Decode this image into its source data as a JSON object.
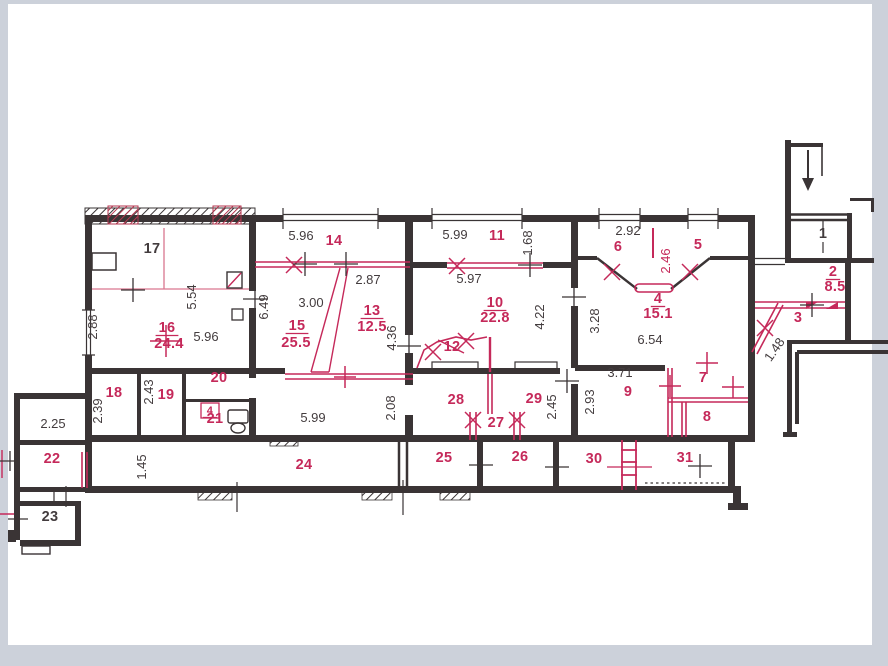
{
  "meta": {
    "type": "apartment-floor-plan",
    "style": "scanned technical drawing (BTI plan) with black walls and red re-planning annotations"
  },
  "colors": {
    "wall": "#3a3435",
    "ink": "#433c3e",
    "red": "#c5295a",
    "redl": "#d9768f",
    "paper": "#ffffff",
    "frame": "#ccd1da"
  },
  "icons": {
    "stairs": "down-arrow",
    "wc": "toilet",
    "shaft": "vent-box-with-red-cross",
    "doors": "red-x-swing-marks",
    "new_openings": "plus-tick-marks"
  },
  "labels": [
    {
      "t": "17",
      "x": 152,
      "y": 253,
      "c": "k",
      "k": "room"
    },
    {
      "t": "16",
      "x": 167,
      "y": 332,
      "c": "r",
      "k": "room",
      "u": 1
    },
    {
      "t": "24.4",
      "x": 169,
      "y": 348,
      "c": "r",
      "k": "room"
    },
    {
      "t": "14",
      "x": 334,
      "y": 245,
      "c": "r",
      "k": "room"
    },
    {
      "t": "15",
      "x": 297,
      "y": 330,
      "c": "r",
      "k": "room",
      "u": 1
    },
    {
      "t": "25.5",
      "x": 296,
      "y": 347,
      "c": "r",
      "k": "room"
    },
    {
      "t": "13",
      "x": 372,
      "y": 315,
      "c": "r",
      "k": "room",
      "u": 1
    },
    {
      "t": "12.5",
      "x": 372,
      "y": 331,
      "c": "r",
      "k": "room"
    },
    {
      "t": "12",
      "x": 452,
      "y": 351,
      "c": "r",
      "k": "room",
      "strike": 1
    },
    {
      "t": "11",
      "x": 497,
      "y": 240,
      "c": "r",
      "k": "room"
    },
    {
      "t": "10",
      "x": 495,
      "y": 307,
      "c": "r",
      "k": "room",
      "u": 1
    },
    {
      "t": "22.8",
      "x": 495,
      "y": 322,
      "c": "r",
      "k": "room"
    },
    {
      "t": "6",
      "x": 618,
      "y": 251,
      "c": "r",
      "k": "room"
    },
    {
      "t": "5",
      "x": 698,
      "y": 249,
      "c": "r",
      "k": "room"
    },
    {
      "t": "4",
      "x": 658,
      "y": 303,
      "c": "r",
      "k": "room",
      "u": 1
    },
    {
      "t": "15.1",
      "x": 658,
      "y": 318,
      "c": "r",
      "k": "room"
    },
    {
      "t": "3",
      "x": 798,
      "y": 322,
      "c": "r",
      "k": "room"
    },
    {
      "t": "2",
      "x": 833,
      "y": 276,
      "c": "r",
      "k": "room",
      "u": 1
    },
    {
      "t": "8.5",
      "x": 835,
      "y": 291,
      "c": "r",
      "k": "room"
    },
    {
      "t": "1",
      "x": 823,
      "y": 238,
      "c": "k",
      "k": "room"
    },
    {
      "t": "9",
      "x": 628,
      "y": 396,
      "c": "r",
      "k": "room"
    },
    {
      "t": "7",
      "x": 703,
      "y": 382,
      "c": "r",
      "k": "room"
    },
    {
      "t": "8",
      "x": 707,
      "y": 421,
      "c": "r",
      "k": "room"
    },
    {
      "t": "18",
      "x": 114,
      "y": 397,
      "c": "r",
      "k": "room"
    },
    {
      "t": "19",
      "x": 166,
      "y": 399,
      "c": "r",
      "k": "room"
    },
    {
      "t": "20",
      "x": 219,
      "y": 382,
      "c": "r",
      "k": "room"
    },
    {
      "t": "21",
      "x": 215,
      "y": 423,
      "c": "r",
      "k": "room"
    },
    {
      "t": "4",
      "x": 210,
      "y": 414,
      "c": "r",
      "k": "room",
      "fs": 11,
      "u": 1,
      "name": "fixture-label"
    },
    {
      "t": "22",
      "x": 52,
      "y": 463,
      "c": "r",
      "k": "room"
    },
    {
      "t": "23",
      "x": 50,
      "y": 521,
      "c": "k",
      "k": "room"
    },
    {
      "t": "24",
      "x": 304,
      "y": 469,
      "c": "r",
      "k": "room"
    },
    {
      "t": "25",
      "x": 444,
      "y": 462,
      "c": "r",
      "k": "room"
    },
    {
      "t": "26",
      "x": 520,
      "y": 461,
      "c": "r",
      "k": "room"
    },
    {
      "t": "27",
      "x": 496,
      "y": 427,
      "c": "r",
      "k": "room"
    },
    {
      "t": "28",
      "x": 456,
      "y": 404,
      "c": "r",
      "k": "room"
    },
    {
      "t": "29",
      "x": 534,
      "y": 403,
      "c": "r",
      "k": "room"
    },
    {
      "t": "30",
      "x": 594,
      "y": 463,
      "c": "r",
      "k": "room"
    },
    {
      "t": "31",
      "x": 685,
      "y": 462,
      "c": "r",
      "k": "room"
    },
    {
      "t": "5.96",
      "x": 301,
      "y": 240,
      "c": "k",
      "k": "dim"
    },
    {
      "t": "5.99",
      "x": 455,
      "y": 239,
      "c": "k",
      "k": "dim"
    },
    {
      "t": "1.68",
      "x": 532,
      "y": 243,
      "c": "k",
      "k": "dim",
      "rot": -90
    },
    {
      "t": "2.92",
      "x": 628,
      "y": 235,
      "c": "k",
      "k": "dim"
    },
    {
      "t": "2.46",
      "x": 670,
      "y": 261,
      "c": "r",
      "k": "dim",
      "rot": -90
    },
    {
      "t": "2.87",
      "x": 368,
      "y": 284,
      "c": "k",
      "k": "dim"
    },
    {
      "t": "5.97",
      "x": 469,
      "y": 283,
      "c": "k",
      "k": "dim"
    },
    {
      "t": "5.54",
      "x": 196,
      "y": 297,
      "c": "k",
      "k": "dim",
      "rot": -90
    },
    {
      "t": "6.49",
      "x": 268,
      "y": 307,
      "c": "k",
      "k": "dim",
      "rot": -90
    },
    {
      "t": "3.00",
      "x": 311,
      "y": 307,
      "c": "k",
      "k": "dim"
    },
    {
      "t": "2.88",
      "x": 97,
      "y": 327,
      "c": "k",
      "k": "dim",
      "rot": -90
    },
    {
      "t": "5.96",
      "x": 206,
      "y": 341,
      "c": "k",
      "k": "dim"
    },
    {
      "t": "4.22",
      "x": 544,
      "y": 317,
      "c": "k",
      "k": "dim",
      "rot": -90
    },
    {
      "t": "3.28",
      "x": 599,
      "y": 321,
      "c": "k",
      "k": "dim",
      "rot": -90
    },
    {
      "t": "6.54",
      "x": 650,
      "y": 344,
      "c": "k",
      "k": "dim"
    },
    {
      "t": "4.36",
      "x": 396,
      "y": 338,
      "c": "k",
      "k": "dim",
      "rot": -90
    },
    {
      "t": "1.48",
      "x": 778,
      "y": 352,
      "c": "k",
      "k": "dim",
      "rot": -55
    },
    {
      "t": "2.39",
      "x": 102,
      "y": 411,
      "c": "k",
      "k": "dim",
      "rot": -90
    },
    {
      "t": "2.43",
      "x": 153,
      "y": 392,
      "c": "k",
      "k": "dim",
      "rot": -90
    },
    {
      "t": "5.99",
      "x": 313,
      "y": 422,
      "c": "k",
      "k": "dim"
    },
    {
      "t": "2.08",
      "x": 395,
      "y": 408,
      "c": "k",
      "k": "dim",
      "rot": -90
    },
    {
      "t": "2.45",
      "x": 556,
      "y": 407,
      "c": "k",
      "k": "dim",
      "rot": -90
    },
    {
      "t": "2.93",
      "x": 594,
      "y": 402,
      "c": "k",
      "k": "dim",
      "rot": -90
    },
    {
      "t": "3.71",
      "x": 620,
      "y": 377,
      "c": "k",
      "k": "dim"
    },
    {
      "t": "2.25",
      "x": 53,
      "y": 428,
      "c": "k",
      "k": "dim"
    },
    {
      "t": "1.45",
      "x": 146,
      "y": 467,
      "c": "k",
      "k": "dim",
      "rot": -90
    }
  ]
}
